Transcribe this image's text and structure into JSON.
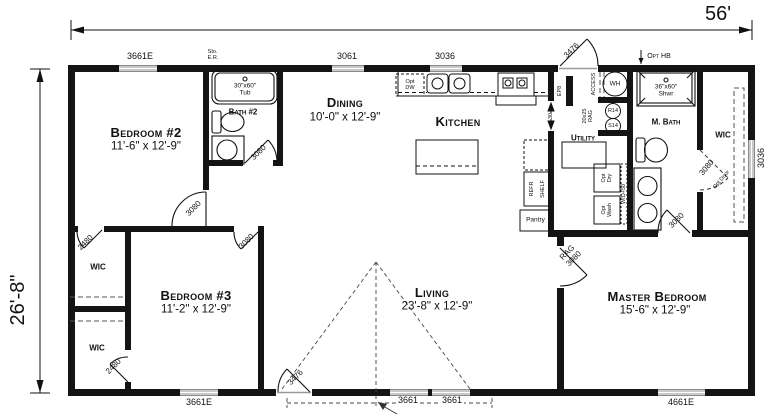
{
  "dimensions": {
    "overall_width": "56'",
    "overall_depth": "26'-8\""
  },
  "rooms": {
    "bedroom2": {
      "name": "Bedroom #2",
      "dims": "11'-6\" x 12'-9\""
    },
    "bedroom3": {
      "name": "Bedroom #3",
      "dims": "11'-2\" x 12'-9\""
    },
    "living": {
      "name": "Living",
      "dims": "23'-8\" x 12'-9\""
    },
    "master": {
      "name": "Master Bedroom",
      "dims": "15'-6\" x 12'-9\""
    },
    "dining": {
      "name": "Dining",
      "dims": "10'-0\" x 12'-9\""
    },
    "kitchen": {
      "name": "Kitchen"
    },
    "bath2": {
      "name": "Bath #2"
    },
    "mbath": {
      "name": "M. Bath"
    },
    "utility": {
      "name": "Utility"
    },
    "pantry": {
      "name": "Pantry"
    },
    "wic_bed2": {
      "name": "WIC"
    },
    "wic_bed3": {
      "name": "WIC"
    },
    "wic_master": {
      "name": "WIC"
    }
  },
  "windows": {
    "top_bed2": "3661E",
    "top_dining": "3061",
    "top_kitchen": "3036",
    "right_wic": "3036",
    "bottom_bed3": "3661E",
    "bottom_living_a": "3661",
    "bottom_living_b": "3661",
    "bottom_master": "4661E"
  },
  "doors": {
    "back": "3476",
    "front": "3476",
    "bed2": "3080",
    "bed3": "3080",
    "bath2": "3080",
    "mbath": "3080",
    "master_rag": "RAG",
    "master": "3080",
    "wic_bed2": "2480",
    "wic_bed3": "2480",
    "wic_master": "3080",
    "wic_master_note": "Opt Door"
  },
  "fixtures": {
    "tub_size": "30\"x60\"",
    "tub": "Tub",
    "shower_size": "36\"x60\"",
    "shower": "Shwr",
    "wh": "WH",
    "access": "ACCESS",
    "rag_size": "20x25",
    "rag": "RAG",
    "r14": "R14",
    "s14": "S14",
    "ep": "EP8",
    "utility_opening": "30",
    "opt_dw_1": "Opt",
    "opt_dw_2": "DW",
    "opt_dry_1": "Opt",
    "opt_dry_2": "Dry",
    "opt_wash_1": "Opt",
    "opt_wash_2": "Wash",
    "wd": "W/D+50",
    "refr": "REFR",
    "shelf": "SHELF",
    "sto_1": "Sto.",
    "sto_2": "E.R.",
    "opt_hb": "Opt HB"
  }
}
